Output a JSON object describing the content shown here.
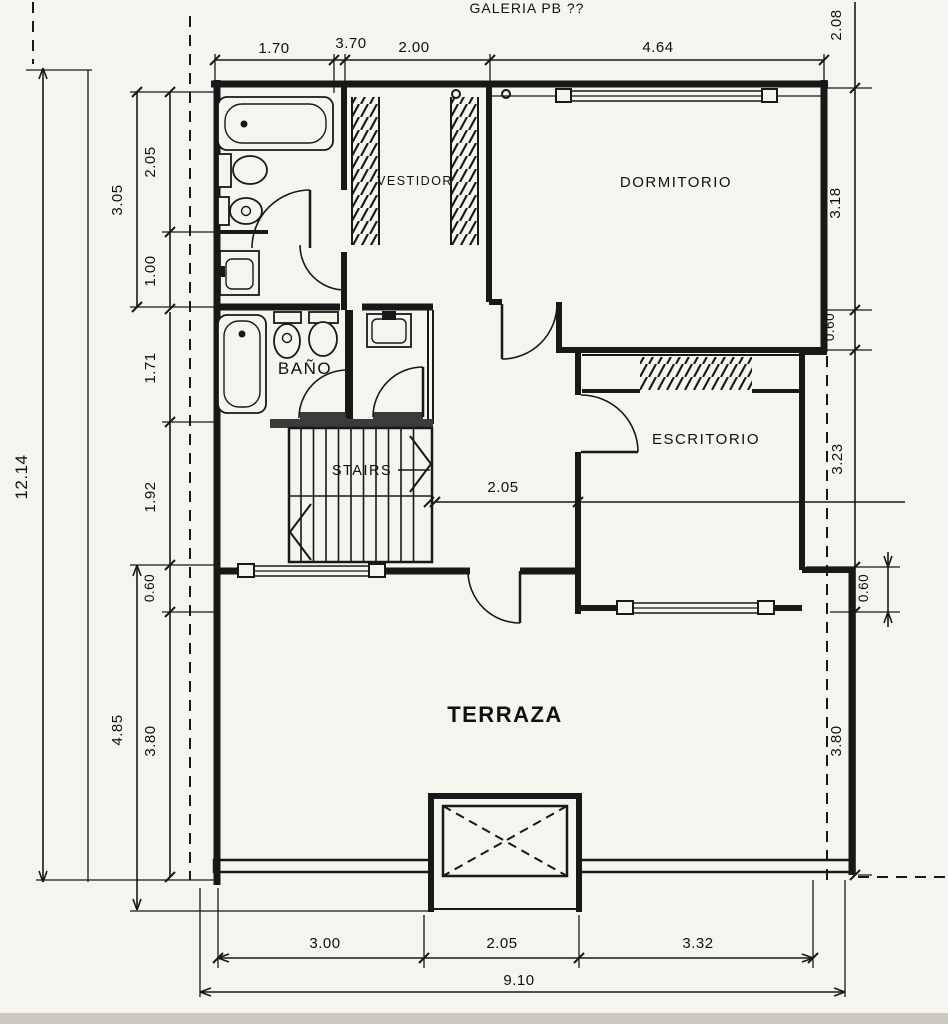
{
  "header": {
    "title": "GALERIA PB ??"
  },
  "rooms": {
    "vestidor": "VESTIDOR",
    "dormitorio": "DORMITORIO",
    "bano": "BAÑO",
    "stairs": "STAIRS",
    "escritorio": "ESCRITORIO",
    "terraza": "TERRAZA"
  },
  "dimensions": {
    "top": {
      "a": "1.70",
      "b": "3.70",
      "c": "2.00",
      "d": "4.64"
    },
    "left": {
      "total": "12.14",
      "a": "3.05",
      "b": "2.05",
      "c": "1.00",
      "d": "1.71",
      "e": "1.92",
      "f": "0.60",
      "g": "4.85",
      "h": "3.80"
    },
    "right": {
      "a": "2.08",
      "b": "3.18",
      "c": "0.60",
      "d": "3.23",
      "e": "0.60",
      "f": "3.80"
    },
    "middle": {
      "a": "2.05"
    },
    "bottom": {
      "a": "3.00",
      "b": "2.05",
      "c": "3.32",
      "total": "9.10"
    }
  },
  "colors": {
    "paper": "#f6f4ee",
    "ink": "#181818",
    "threshold": "#3b3b3b"
  }
}
